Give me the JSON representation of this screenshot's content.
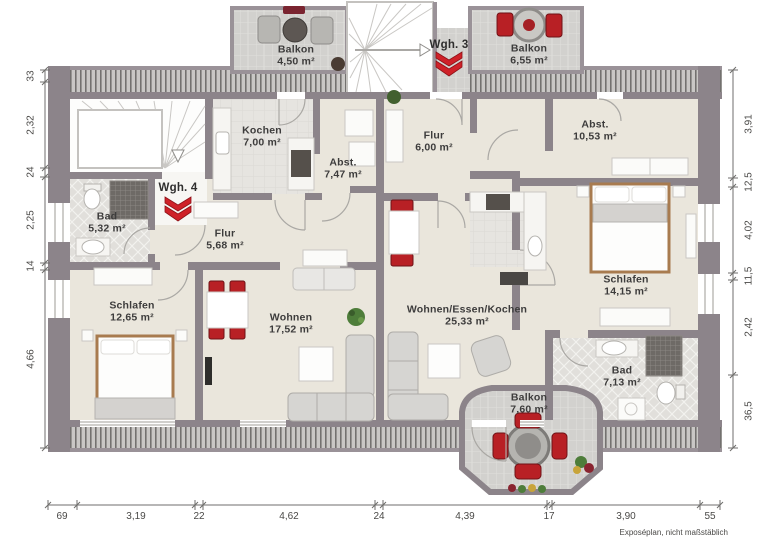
{
  "units": {
    "wgh3": "Wgh. 3",
    "wgh4": "Wgh. 4"
  },
  "rooms": {
    "balkon_tl": {
      "name": "Balkon",
      "area": "4,50 m²"
    },
    "balkon_tr": {
      "name": "Balkon",
      "area": "6,55 m²"
    },
    "kochen": {
      "name": "Kochen",
      "area": "7,00 m²"
    },
    "abst4": {
      "name": "Abst.",
      "area": "7,47 m²"
    },
    "bad4": {
      "name": "Bad",
      "area": "5,32 m²"
    },
    "flur4": {
      "name": "Flur",
      "area": "5,68 m²"
    },
    "schlafen4": {
      "name": "Schlafen",
      "area": "12,65 m²"
    },
    "wohnen4": {
      "name": "Wohnen",
      "area": "17,52 m²"
    },
    "flur3": {
      "name": "Flur",
      "area": "6,00 m²"
    },
    "abst3": {
      "name": "Abst.",
      "area": "10,53 m²"
    },
    "schlafen3": {
      "name": "Schlafen",
      "area": "14,15 m²"
    },
    "bad3": {
      "name": "Bad",
      "area": "7,13 m²"
    },
    "wek3": {
      "name": "Wohnen/Essen/Kochen",
      "area": "25,33 m²"
    },
    "balkon_b": {
      "name": "Balkon",
      "area": "7,60 m²"
    }
  },
  "dimensions": {
    "left": [
      "33",
      "2,32",
      "24",
      "2,25",
      "14",
      "4,66"
    ],
    "right": [
      "3,91",
      "12,5",
      "4,02",
      "11,5",
      "2,42",
      "36,5"
    ],
    "bottom": [
      "69",
      "3,19",
      "22",
      "4,62",
      "24",
      "4,39",
      "17",
      "3,90",
      "55"
    ]
  },
  "footer": {
    "disclaimer": "Exposéplan, nicht maßstäblich"
  },
  "colors": {
    "wall": "#8c848a",
    "floor": "#eae6dc",
    "tile": "#d0cecb",
    "accent_red": "#cf2128"
  }
}
